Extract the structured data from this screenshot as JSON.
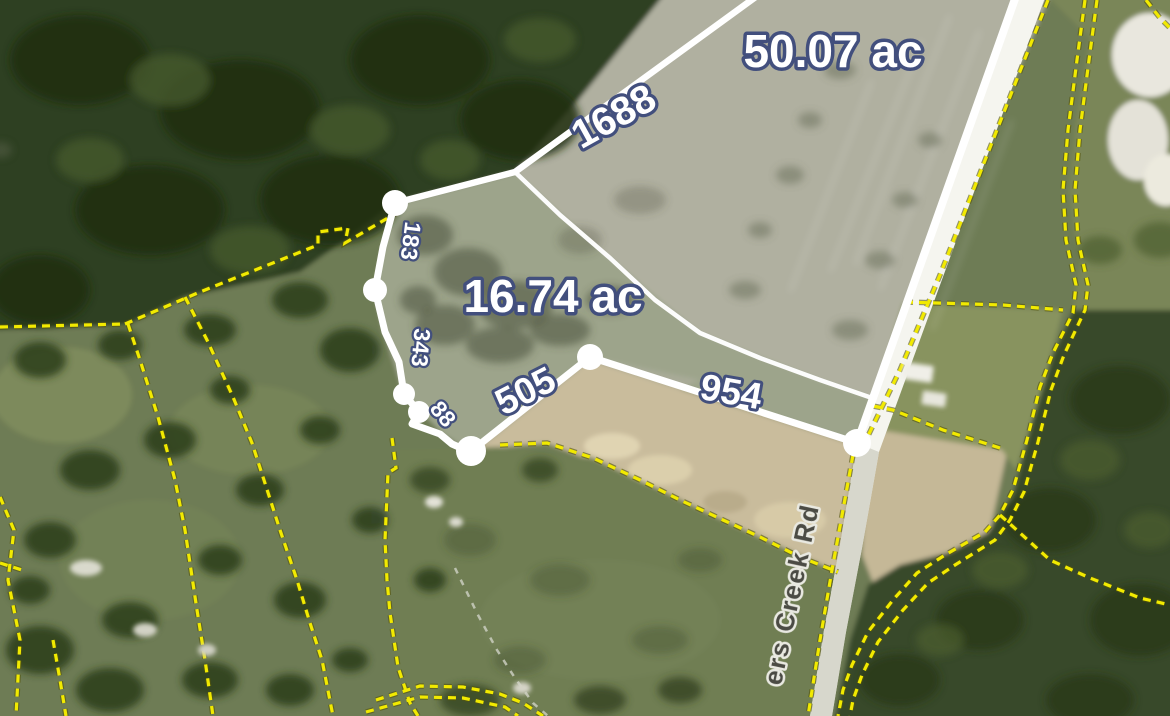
{
  "map": {
    "description": "Aerial parcel map with measured lot boundaries",
    "parcels": [
      {
        "area_label": "50.07 ac"
      },
      {
        "area_label": "16.74 ac",
        "segment_lengths": [
          "1688",
          "183",
          "343",
          "88",
          "505",
          "954"
        ]
      }
    ],
    "road": {
      "name_label": "ers Creek Rd"
    },
    "colors": {
      "measurement_line": "#ffffff",
      "measurement_label_fill": "#ffffff",
      "measurement_label_outline": "#424f7d",
      "parcel_boundary_yellow": "#f2ea00",
      "road_text": "#4b4b44",
      "forest_dark_green": "#2f3f20",
      "field_light_gray": "#b0b0a0",
      "field_green": "#6e7c55",
      "dirt_tan": "#c9bc9c",
      "road_white": "#f5f5ef"
    }
  }
}
